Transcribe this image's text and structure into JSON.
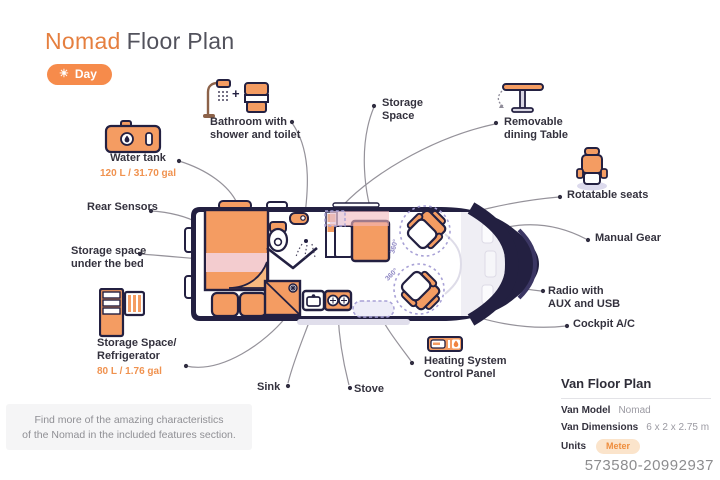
{
  "title": {
    "brand": "Nomad",
    "rest": "Floor Plan"
  },
  "mode": {
    "icon_glyph": "☀",
    "label": "Day"
  },
  "callouts": {
    "water_tank": {
      "title": "Water tank",
      "value": "120 L / 31.70 gal"
    },
    "rear_sensors": {
      "title": "Rear Sensors"
    },
    "storage_bed": {
      "line1": "Storage space",
      "line2": "under the bed"
    },
    "fridge": {
      "line1": "Storage Space/",
      "line2": "Refrigerator",
      "value": "80 L / 1.76 gal"
    },
    "bathroom": {
      "line1": "Bathroom with",
      "line2": "shower and toilet"
    },
    "storage_space": {
      "line1": "Storage",
      "line2": "Space"
    },
    "dining_table": {
      "line1": "Removable",
      "line2": "dining Table"
    },
    "rotatable_seats": {
      "title": "Rotatable seats"
    },
    "manual_gear": {
      "title": "Manual Gear"
    },
    "radio": {
      "line1": "Radio with",
      "line2": "AUX and USB"
    },
    "cockpit_ac": {
      "title": "Cockpit A/C"
    },
    "heating": {
      "line1": "Heating System",
      "line2": "Control Panel"
    },
    "sink": {
      "title": "Sink"
    },
    "stove": {
      "title": "Stove"
    }
  },
  "van": {
    "seat_rotation": "360°"
  },
  "note": {
    "line1": "Find more of the amazing characteristics",
    "line2": "of the Nomad in the included features section."
  },
  "panel": {
    "heading": "Van Floor Plan",
    "model_label": "Van Model",
    "model_value": "Nomad",
    "dims_label": "Van Dimensions",
    "dims_value": "6 x 2 x 2.75 m",
    "units_label": "Units",
    "units_value": "Meter"
  },
  "watermark": "573580-20992937",
  "colors": {
    "accent": "#F68B4B",
    "navy": "#232041",
    "interior_orange": "#F49C62",
    "pink": "#F3CCCF",
    "lavender": "#A8A1D6",
    "leader_gray": "#95929A"
  }
}
